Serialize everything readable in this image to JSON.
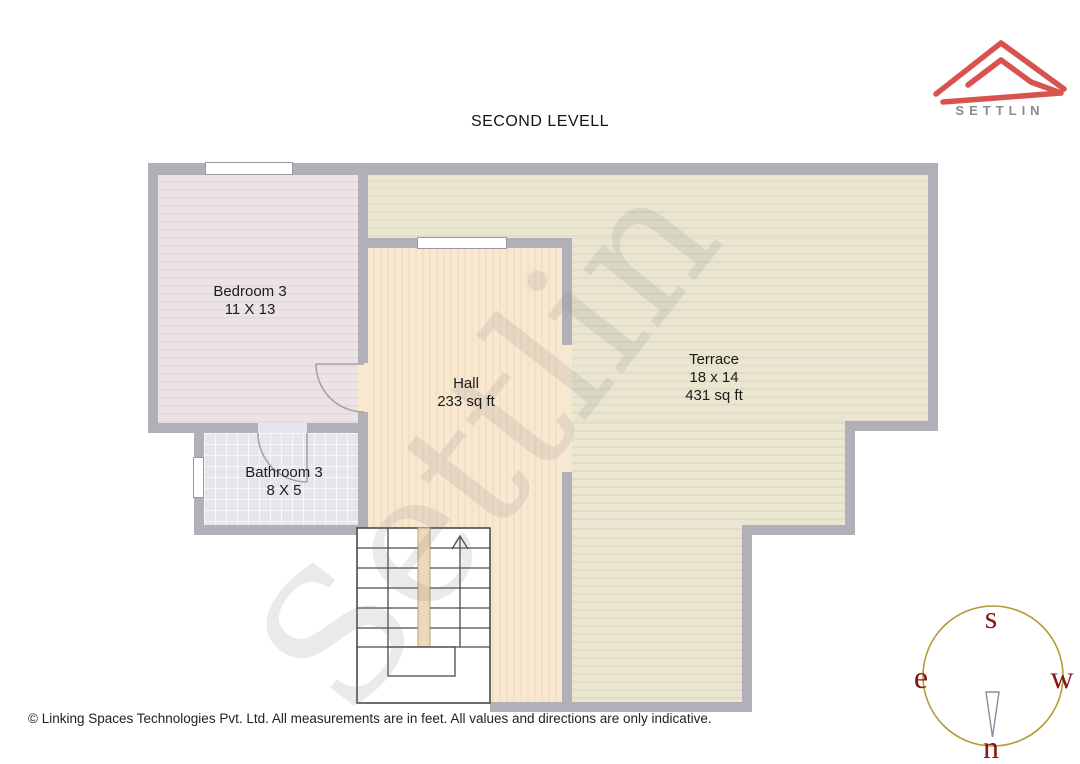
{
  "title": "SECOND LEVELL",
  "brand": {
    "name": "SETTLIN"
  },
  "watermark": "Settlin",
  "rooms": {
    "bedroom": {
      "name": "Bedroom 3",
      "size": "11 X 13"
    },
    "hall": {
      "name": "Hall",
      "area": "233 sq ft"
    },
    "bathroom": {
      "name": "Bathroom 3",
      "size": "8 X 5"
    },
    "terrace": {
      "name": "Terrace",
      "size": "18 x 14",
      "area": "431 sq ft"
    }
  },
  "compass": {
    "top": "s",
    "left": "e",
    "right": "w",
    "bottom": "n"
  },
  "footer": "© Linking Spaces Technologies Pvt. Ltd. All measurements are in feet. All values and directions are only indicative.",
  "colors": {
    "wall": "#b1afb7",
    "bedroom-base": "#ebe3e6",
    "bedroom-stripe": "#e4dcdf",
    "hall-base": "#f9e8d0",
    "hall-stripe": "#f3e0c5",
    "terrace-base": "#eae6d1",
    "terrace-stripe": "#e1ddc6",
    "bath-base": "#e7e5ec",
    "bath-grid": "#f7f7fa",
    "stairs-line": "#4a4a4a",
    "divider-fill": "#ecd9ba",
    "divider-edge": "#bf9f77",
    "door-arc": "#aaa1a3",
    "logo-red": "#d8534e",
    "brand-gray": "#8c8c8c",
    "compass-ring": "#b29b37",
    "compass-letter": "#8b1414",
    "needle-stroke": "#9187a0",
    "text-dark": "#1c1c1c",
    "window-border": "#9a99a1"
  }
}
